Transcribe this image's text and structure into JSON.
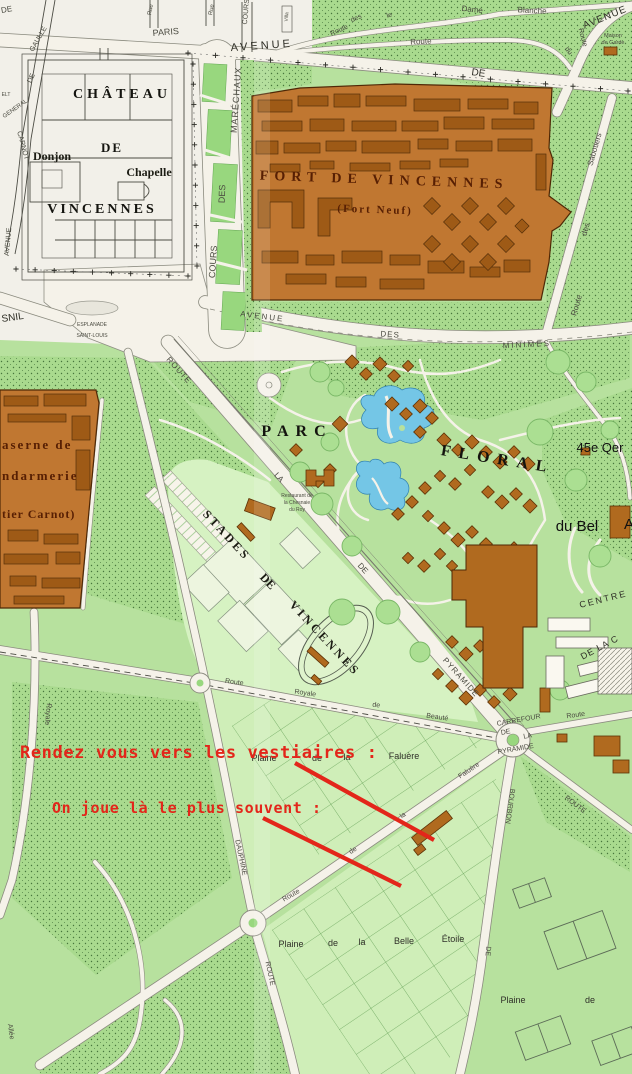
{
  "annotations": {
    "color": "#e3261a",
    "note1": {
      "text": "Rendez vous vers les vestiaires :",
      "x": 20,
      "y": 758,
      "size": 17
    },
    "note2": {
      "text": "On joue là le plus souvent :",
      "x": 52,
      "y": 813,
      "size": 15
    },
    "lines": [
      [
        295,
        763,
        434,
        840
      ],
      [
        263,
        818,
        401,
        886
      ]
    ]
  },
  "colors": {
    "park_green": "#b7e19e",
    "stipple_green": "#a9da8e",
    "field_green": "#cfeeb8",
    "building_orange": "#c07731",
    "water_blue": "#74c6e6",
    "road_white": "#f5f2e9",
    "annotation_red": "#e3261a"
  },
  "map_labels": [
    {
      "text": "DE",
      "x": 7,
      "y": 12,
      "size": 8,
      "rot": -10,
      "cls": "tiny"
    },
    {
      "text": "PARIS",
      "x": 166,
      "y": 35,
      "size": 9,
      "rot": -5,
      "cls": "tiny"
    },
    {
      "text": "AVENUE",
      "x": 262,
      "y": 49,
      "size": 11,
      "rot": -4,
      "cls": "roadbig",
      "ls": 3
    },
    {
      "text": "Rue",
      "x": 152,
      "y": 10,
      "size": 6,
      "rot": -80,
      "cls": "tiny"
    },
    {
      "text": "Rue",
      "x": 213,
      "y": 10,
      "size": 6,
      "rot": -80,
      "cls": "tiny"
    },
    {
      "text": "COURS",
      "x": 248,
      "y": 12,
      "size": 7,
      "rot": -85,
      "cls": "tiny"
    },
    {
      "text": "Villa",
      "x": 288,
      "y": 17,
      "size": 5,
      "rot": -85,
      "cls": "tiny"
    },
    {
      "text": "Route",
      "x": 340,
      "y": 32,
      "size": 7,
      "rot": -25,
      "cls": "tiny"
    },
    {
      "text": "des",
      "x": 357,
      "y": 20,
      "size": 7,
      "rot": -25,
      "cls": "tiny"
    },
    {
      "text": "le",
      "x": 390,
      "y": 17,
      "size": 7,
      "rot": -18,
      "cls": "tiny"
    },
    {
      "text": "Dame",
      "x": 472,
      "y": 12,
      "size": 8,
      "rot": 6,
      "cls": "tiny"
    },
    {
      "text": "Blanche",
      "x": 532,
      "y": 13,
      "size": 8,
      "rot": 3,
      "cls": "tiny"
    },
    {
      "text": "Route",
      "x": 421,
      "y": 44,
      "size": 8,
      "rot": -3,
      "cls": "tiny"
    },
    {
      "text": "DE",
      "x": 478,
      "y": 76,
      "size": 10,
      "rot": 8,
      "cls": "roadbig"
    },
    {
      "text": "AVENUE",
      "x": 606,
      "y": 20,
      "size": 10,
      "rot": -22,
      "cls": "roadbig",
      "ls": 1
    },
    {
      "text": "Route",
      "x": 581,
      "y": 38,
      "size": 7,
      "rot": 75,
      "cls": "tiny"
    },
    {
      "text": "du",
      "x": 567,
      "y": 52,
      "size": 7,
      "rot": 55,
      "cls": "tiny"
    },
    {
      "text": "Maison",
      "x": 613,
      "y": 37,
      "size": 5.5,
      "cls": "tiny"
    },
    {
      "text": "de Garde",
      "x": 613,
      "y": 44,
      "size": 5.5,
      "cls": "tiny"
    },
    {
      "text": "Sabotiers",
      "x": 597,
      "y": 150,
      "size": 8,
      "rot": -74,
      "cls": "tiny"
    },
    {
      "text": "des",
      "x": 588,
      "y": 230,
      "size": 8,
      "rot": -74,
      "cls": "tiny"
    },
    {
      "text": "Route",
      "x": 579,
      "y": 306,
      "size": 8,
      "rot": -74,
      "cls": "tiny"
    },
    {
      "text": "CHÂTEAU",
      "x": 122,
      "y": 98,
      "size": 14,
      "cls": "serifbig",
      "ls": 4
    },
    {
      "text": "DE",
      "x": 112,
      "y": 152,
      "size": 13,
      "cls": "serifbig",
      "ls": 2
    },
    {
      "text": "VINCENNES",
      "x": 102,
      "y": 213,
      "size": 14,
      "cls": "serifbig",
      "ls": 3
    },
    {
      "text": "Donjon",
      "x": 52,
      "y": 160,
      "size": 12,
      "cls": "serifmed"
    },
    {
      "text": "Chapelle",
      "x": 149,
      "y": 176,
      "size": 12,
      "cls": "serifmed"
    },
    {
      "text": "MARÉCHAUX",
      "x": 239,
      "y": 100,
      "size": 9,
      "rot": -86,
      "cls": "tiny",
      "ls": 1
    },
    {
      "text": "DES",
      "x": 225,
      "y": 194,
      "size": 9,
      "rot": -88,
      "cls": "tiny"
    },
    {
      "text": "COURS",
      "x": 216,
      "y": 262,
      "size": 9,
      "rot": -86,
      "cls": "tiny"
    },
    {
      "text": "GAULLE",
      "x": 40,
      "y": 40,
      "size": 7,
      "rot": -60,
      "cls": "tiny"
    },
    {
      "text": "DE",
      "x": 33,
      "y": 79,
      "size": 7,
      "rot": -65,
      "cls": "tiny"
    },
    {
      "text": "GENERAL",
      "x": 16,
      "y": 110,
      "size": 6,
      "rot": -35,
      "cls": "tiny"
    },
    {
      "text": "ELT",
      "x": 6,
      "y": 96,
      "size": 5,
      "cls": "tiny"
    },
    {
      "text": "CARNOT",
      "x": 21,
      "y": 146,
      "size": 7,
      "rot": 75,
      "cls": "tiny"
    },
    {
      "text": "AVENUE",
      "x": 10,
      "y": 242,
      "size": 7,
      "rot": -85,
      "cls": "tiny"
    },
    {
      "text": "SNIL",
      "x": 2,
      "y": 322,
      "size": 10,
      "rot": -8,
      "cls": "roadbig",
      "anchor": "start"
    },
    {
      "text": "ESPLANADE",
      "x": 92,
      "y": 326,
      "size": 5,
      "cls": "tiny"
    },
    {
      "text": "SAINT-LOUIS",
      "x": 92,
      "y": 337,
      "size": 5,
      "cls": "tiny"
    },
    {
      "text": "FORT DE VINCENNES",
      "x": 384,
      "y": 184,
      "size": 14,
      "rot": 2,
      "cls": "fort",
      "ls": 6
    },
    {
      "text": "(Fort Neuf)",
      "x": 375,
      "y": 213,
      "size": 11,
      "rot": 2,
      "cls": "fortsub",
      "ls": 2
    },
    {
      "text": "aserne de",
      "x": 2,
      "y": 449,
      "size": 13,
      "cls": "fort",
      "ls": 2,
      "anchor": "start"
    },
    {
      "text": "ndarmerie",
      "x": 2,
      "y": 480,
      "size": 13,
      "cls": "fort",
      "ls": 2,
      "anchor": "start"
    },
    {
      "text": "tier Carnot)",
      "x": 2,
      "y": 518,
      "size": 12,
      "cls": "fort",
      "ls": 1,
      "anchor": "start"
    },
    {
      "text": "AVENUE",
      "x": 262,
      "y": 319,
      "size": 8,
      "rot": 7,
      "cls": "tiny",
      "ls": 2
    },
    {
      "text": "DES",
      "x": 390,
      "y": 337,
      "size": 8,
      "rot": 4,
      "cls": "tiny",
      "ls": 1
    },
    {
      "text": "MINIMES",
      "x": 527,
      "y": 347,
      "size": 8,
      "rot": -3,
      "cls": "tiny",
      "ls": 2
    },
    {
      "text": "PARC",
      "x": 297,
      "y": 436,
      "size": 16,
      "cls": "serifbig",
      "ls": 7
    },
    {
      "text": "FLORAL",
      "x": 497,
      "y": 464,
      "size": 16,
      "rot": 9,
      "cls": "serifbig",
      "ls": 8
    },
    {
      "text": "45e Qer",
      "x": 600,
      "y": 452,
      "size": 13,
      "cls": "sansmed"
    },
    {
      "text": "du Bel",
      "x": 577,
      "y": 531,
      "size": 15,
      "cls": "sansmed"
    },
    {
      "text": "A",
      "x": 629,
      "y": 529,
      "size": 15,
      "cls": "sansmed"
    },
    {
      "text": "Restaurant de",
      "x": 297,
      "y": 497,
      "size": 5,
      "cls": "tiny"
    },
    {
      "text": "la Chesnaie",
      "x": 297,
      "y": 504,
      "size": 5,
      "cls": "tiny"
    },
    {
      "text": "du Roy",
      "x": 297,
      "y": 511,
      "size": 5,
      "cls": "tiny"
    },
    {
      "text": "CENTRE",
      "x": 604,
      "y": 602,
      "size": 9,
      "rot": -14,
      "cls": "roadbig",
      "ls": 2
    },
    {
      "text": "DE LA C",
      "x": 601,
      "y": 650,
      "size": 9,
      "rot": -28,
      "cls": "roadbig",
      "ls": 1
    },
    {
      "text": "ROUTE",
      "x": 177,
      "y": 372,
      "size": 8,
      "rot": 48,
      "cls": "tiny",
      "ls": 1
    },
    {
      "text": "LA",
      "x": 277,
      "y": 479,
      "size": 8,
      "rot": 48,
      "cls": "tiny"
    },
    {
      "text": "DE",
      "x": 361,
      "y": 570,
      "size": 8,
      "rot": 48,
      "cls": "tiny"
    },
    {
      "text": "PYRAMIDE",
      "x": 459,
      "y": 679,
      "size": 8,
      "rot": 48,
      "cls": "tiny",
      "ls": 1
    },
    {
      "text": "STADES",
      "x": 224,
      "y": 538,
      "size": 12,
      "rot": 47,
      "cls": "serifmed",
      "ls": 3
    },
    {
      "text": "DE",
      "x": 265,
      "y": 584,
      "size": 12,
      "rot": 47,
      "cls": "serifmed"
    },
    {
      "text": "VINCENNES",
      "x": 322,
      "y": 641,
      "size": 12,
      "rot": 47,
      "cls": "serifmed",
      "ls": 3
    },
    {
      "text": "Route",
      "x": 234,
      "y": 684,
      "size": 7,
      "rot": 8,
      "cls": "tiny"
    },
    {
      "text": "Royale",
      "x": 305,
      "y": 695,
      "size": 7,
      "rot": 8,
      "cls": "tiny"
    },
    {
      "text": "de",
      "x": 376,
      "y": 707,
      "size": 7,
      "rot": 8,
      "cls": "tiny"
    },
    {
      "text": "Beauté",
      "x": 437,
      "y": 719,
      "size": 7,
      "rot": 8,
      "cls": "tiny"
    },
    {
      "text": "Royale",
      "x": 46,
      "y": 714,
      "size": 7,
      "rot": 95,
      "cls": "tiny"
    },
    {
      "text": "Allée",
      "x": 9,
      "y": 1032,
      "size": 7,
      "rot": 82,
      "cls": "tiny"
    },
    {
      "text": "CARREFOUR",
      "x": 519,
      "y": 722,
      "size": 7,
      "rot": -10,
      "cls": "tiny"
    },
    {
      "text": "DE",
      "x": 506,
      "y": 734,
      "size": 7,
      "rot": -10,
      "cls": "tiny"
    },
    {
      "text": "LA",
      "x": 528,
      "y": 738,
      "size": 7,
      "rot": -10,
      "cls": "tiny"
    },
    {
      "text": "PYRAMIDE",
      "x": 516,
      "y": 751,
      "size": 7,
      "rot": -10,
      "cls": "tiny"
    },
    {
      "text": "Route",
      "x": 576,
      "y": 717,
      "size": 7,
      "rot": -8,
      "cls": "tiny"
    },
    {
      "text": "ROUTE",
      "x": 574,
      "y": 806,
      "size": 7,
      "rot": 38,
      "cls": "tiny"
    },
    {
      "text": "BOURBON",
      "x": 508,
      "y": 806,
      "size": 7,
      "rot": 98,
      "cls": "tiny"
    },
    {
      "text": "DE",
      "x": 486,
      "y": 951,
      "size": 7,
      "rot": 96,
      "cls": "tiny"
    },
    {
      "text": "Faluère",
      "x": 470,
      "y": 772,
      "size": 7,
      "rot": -34,
      "cls": "tiny"
    },
    {
      "text": "la",
      "x": 404,
      "y": 817,
      "size": 7,
      "rot": -34,
      "cls": "tiny"
    },
    {
      "text": "de",
      "x": 354,
      "y": 852,
      "size": 7,
      "rot": -34,
      "cls": "tiny"
    },
    {
      "text": "Route",
      "x": 292,
      "y": 897,
      "size": 7,
      "rot": -30,
      "cls": "tiny"
    },
    {
      "text": "DAUPHINE",
      "x": 239,
      "y": 858,
      "size": 7,
      "rot": 78,
      "cls": "tiny"
    },
    {
      "text": "Plaine",
      "x": 264,
      "y": 761,
      "size": 9,
      "cls": "sanssm"
    },
    {
      "text": "de",
      "x": 317,
      "y": 761,
      "size": 9,
      "cls": "sanssm"
    },
    {
      "text": "la",
      "x": 347,
      "y": 760,
      "size": 9,
      "cls": "sanssm"
    },
    {
      "text": "Faluère",
      "x": 404,
      "y": 759,
      "size": 9,
      "cls": "sanssm"
    },
    {
      "text": "Plaine",
      "x": 291,
      "y": 947,
      "size": 9,
      "cls": "sanssm"
    },
    {
      "text": "de",
      "x": 333,
      "y": 946,
      "size": 9,
      "cls": "sanssm"
    },
    {
      "text": "la",
      "x": 362,
      "y": 945,
      "size": 9,
      "cls": "sanssm"
    },
    {
      "text": "Belle",
      "x": 404,
      "y": 944,
      "size": 9,
      "cls": "sanssm"
    },
    {
      "text": "Étoile",
      "x": 453,
      "y": 942,
      "size": 9,
      "cls": "sanssm"
    },
    {
      "text": "ROUTE",
      "x": 268,
      "y": 974,
      "size": 7,
      "rot": 78,
      "cls": "tiny"
    },
    {
      "text": "Plaine",
      "x": 513,
      "y": 1003,
      "size": 9,
      "cls": "sanssm"
    },
    {
      "text": "de",
      "x": 590,
      "y": 1003,
      "size": 9,
      "cls": "sanssm"
    }
  ]
}
